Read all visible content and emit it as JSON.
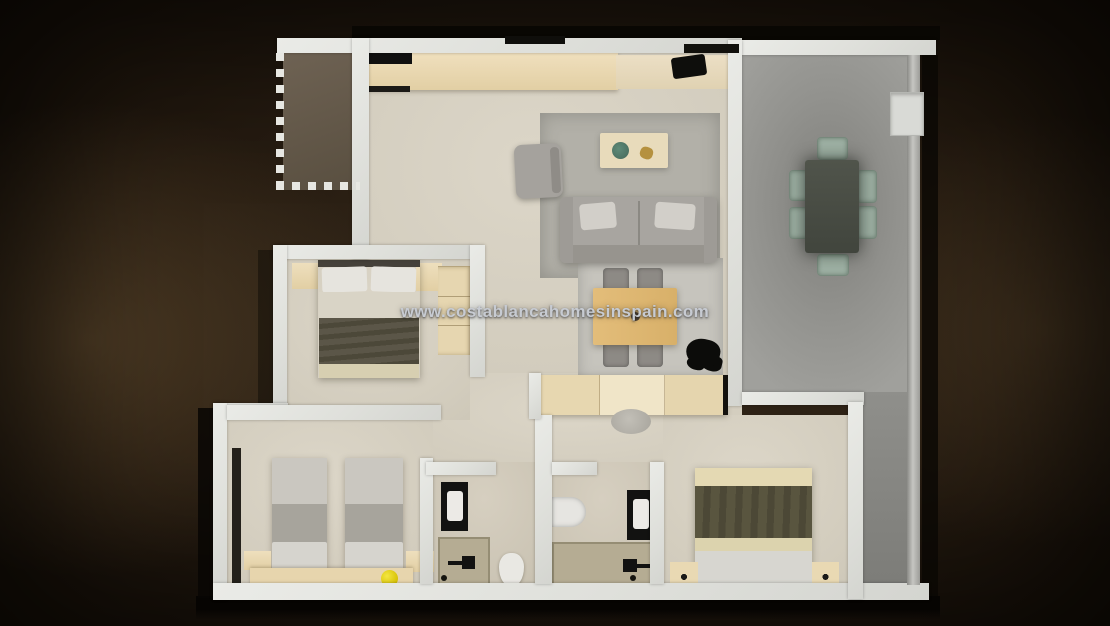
{
  "watermark": {
    "text": "www.costablancahomesinspain.com"
  },
  "palette": {
    "background_dark": "#130d06",
    "background_glow": "#4a3a27",
    "wall": "#e2e3df",
    "floor_cream": "#d2ccbd",
    "balcony_floor": "#665a49",
    "terrace_floor": "#96968f",
    "kitchen_counter": "#e8d6af",
    "wood_table": "#ddb673",
    "sofa_gray": "#a8a5a0",
    "rug_gray": "#b2b0a8",
    "blanket_olive": "#54503f",
    "outdoor_chair_sage": "#9db0a3",
    "outdoor_table_dark": "#484c44",
    "fixture_black": "#121211",
    "shower_tray_tan": "#b5ac93",
    "ball_yellow": "#e6d41b",
    "watermark_text": "#c7cbd2"
  }
}
